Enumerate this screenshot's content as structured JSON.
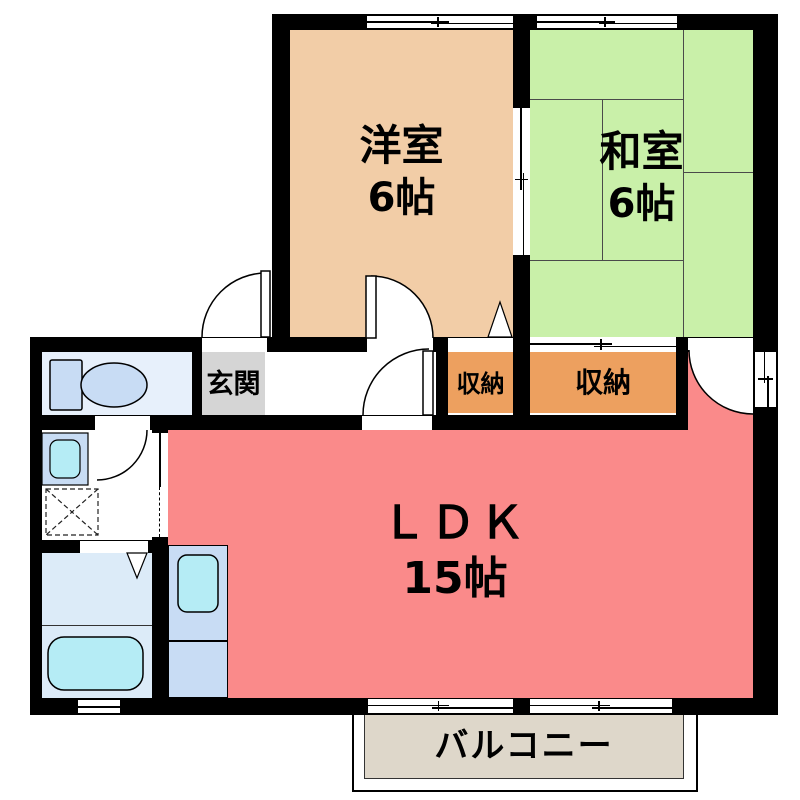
{
  "title": "apartment-floor-plan",
  "rooms": {
    "western": {
      "label": "洋室",
      "size": "6帖"
    },
    "japanese": {
      "label": "和室",
      "size": "6帖"
    },
    "ldk": {
      "label": "ＬＤＫ",
      "size": "15帖"
    },
    "entrance": {
      "label": "玄関"
    },
    "storage_small": {
      "label": "収納"
    },
    "storage_large": {
      "label": "収納"
    },
    "balcony": {
      "label": "バルコニー"
    }
  },
  "fixtures": {
    "toilet": "toilet-icon",
    "washbasin": "washbasin-icon",
    "washing_machine": "washing-machine-icon",
    "bathtub": "bathtub-icon",
    "kitchen_sink": "kitchen-sink-icon"
  },
  "colors": {
    "wall": "#000000",
    "western": "#f2cda7",
    "japanese": "#c9f0a9",
    "storage": "#eda05f",
    "ldk": "#fa8a8a",
    "entrance_floor": "#d5d5d5",
    "toilet_room": "#e7f0fb",
    "bathroom": "#dcebf8",
    "fixture_blue": "#c8dcf4",
    "fixture_cyan": "#b5ecf5",
    "balcony": "#ded7ca",
    "tatami_line": "#4a4a4a"
  }
}
